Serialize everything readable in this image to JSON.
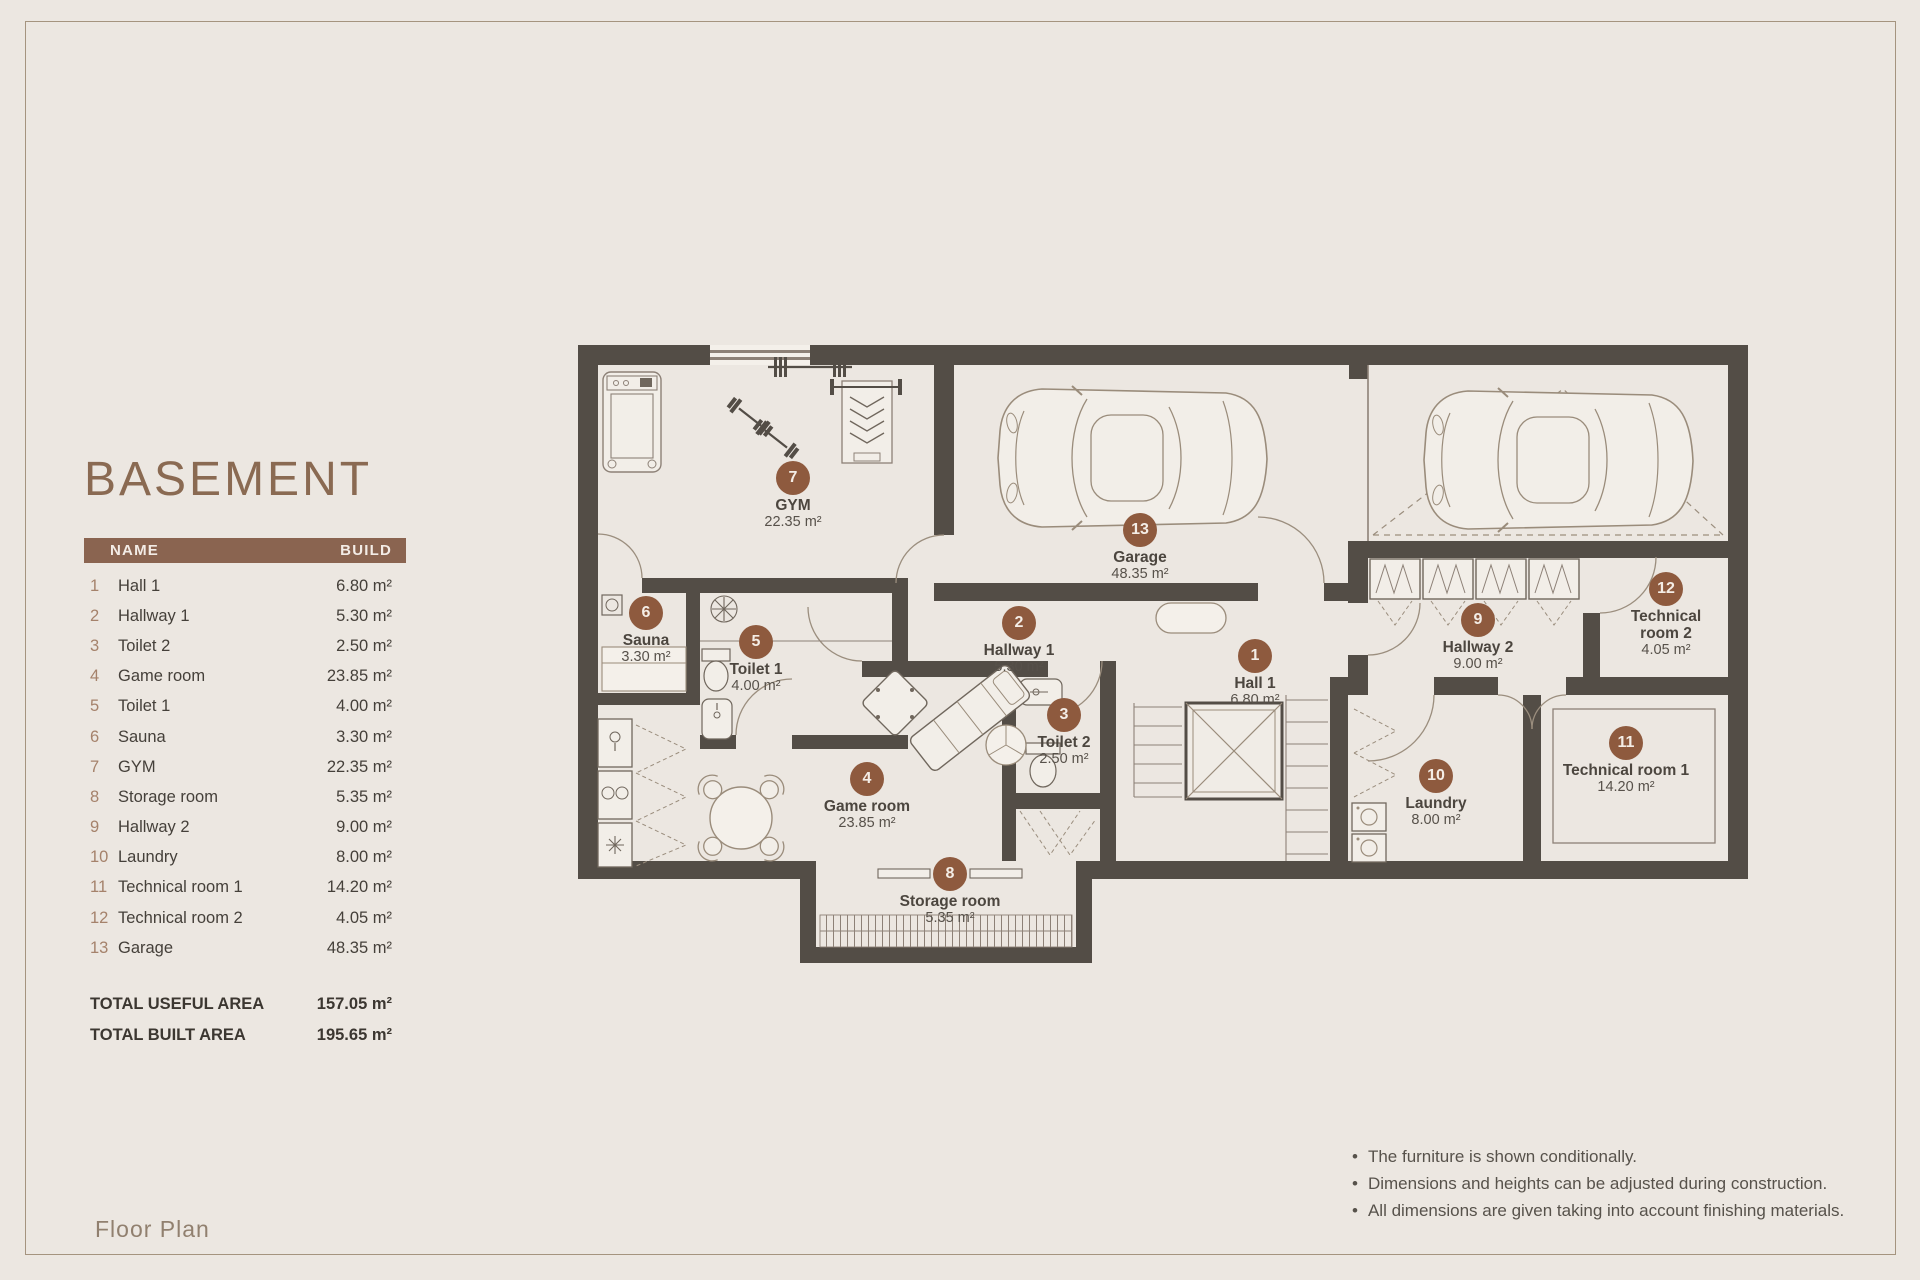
{
  "title": "BASEMENT",
  "footer_label": "Floor Plan",
  "table": {
    "name_header": "NAME",
    "build_header": "BUILD",
    "totals": [
      {
        "label": "TOTAL USEFUL AREA",
        "value": "157.05 m²"
      },
      {
        "label": "TOTAL BUILT AREA",
        "value": "195.65 m²"
      }
    ]
  },
  "rooms": [
    {
      "num": "1",
      "name": "Hall 1",
      "area": "6.80 m²"
    },
    {
      "num": "2",
      "name": "Hallway 1",
      "area": "5.30 m²"
    },
    {
      "num": "3",
      "name": "Toilet 2",
      "area": "2.50 m²"
    },
    {
      "num": "4",
      "name": "Game room",
      "area": "23.85 m²"
    },
    {
      "num": "5",
      "name": "Toilet 1",
      "area": "4.00 m²"
    },
    {
      "num": "6",
      "name": "Sauna",
      "area": "3.30 m²"
    },
    {
      "num": "7",
      "name": "GYM",
      "area": "22.35 m²"
    },
    {
      "num": "8",
      "name": "Storage room",
      "area": "5.35 m²"
    },
    {
      "num": "9",
      "name": "Hallway 2",
      "area": "9.00 m²"
    },
    {
      "num": "10",
      "name": "Laundry",
      "area": "8.00 m²"
    },
    {
      "num": "11",
      "name": "Technical room 1",
      "area": "14.20 m²"
    },
    {
      "num": "12",
      "name": "Technical room 2",
      "area": "4.05 m²"
    },
    {
      "num": "13",
      "name": "Garage",
      "area": "48.35 m²"
    }
  ],
  "notes": [
    "The furniture is shown conditionally.",
    "Dimensions and heights can be adjusted during construction.",
    "All dimensions are given taking into account finishing materials."
  ],
  "colors": {
    "background": "#ECE7E1",
    "accent_brown": "#8A6450",
    "badge_brown": "#8E5A3E",
    "wall": "#534D46"
  }
}
